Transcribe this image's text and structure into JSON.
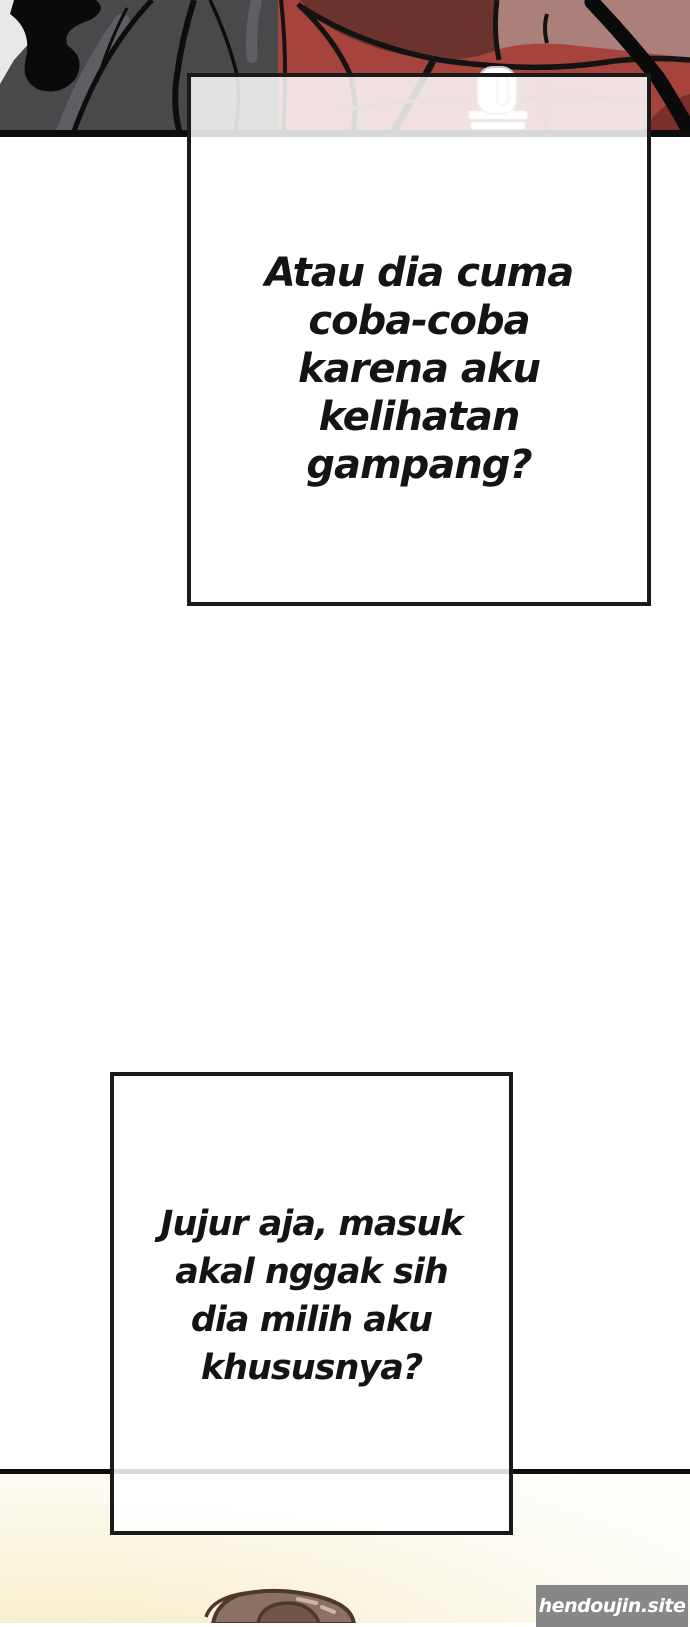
{
  "page": {
    "width_px": 690,
    "height_px": 1623,
    "background": "#ffffff"
  },
  "speech_bubbles": [
    {
      "id": "bubble-1",
      "lines": [
        "Atau dia cuma",
        "coba-coba",
        "karena aku",
        "kelihatan",
        "gampang?"
      ],
      "border_color": "#1a1a1a",
      "fill": "rgba(255,255,255,0.85)"
    },
    {
      "id": "bubble-2",
      "lines": [
        "Jujur aja, masuk",
        "akal nggak sih",
        "dia milih aku",
        "khususnya?"
      ],
      "border_color": "#1a1a1a",
      "fill": "rgba(255,255,255,0.85)"
    }
  ],
  "panels": {
    "top_artwork_colors": {
      "hair_gray": "#47494b",
      "line_black": "#0d0d0d",
      "corner_light_gray": "#e8e8e8",
      "jacket_red": "#a5433c",
      "jacket_maroon": "#6b322e",
      "jacket_mauve": "#ab807b",
      "jacket_dark_red": "#7c2f2a",
      "zipper_white": "#ffffff"
    },
    "divider_color": "#0d0d0d",
    "bottom_panel_colors": {
      "background_cream": "#f5ebc6",
      "hair_brown": "#8a7162",
      "hair_brown_dark": "#6f5649",
      "hair_outline": "#4f382b"
    }
  },
  "watermark": {
    "text": "hendoujin.site",
    "background": "#878787",
    "text_color": "#ffffff"
  }
}
